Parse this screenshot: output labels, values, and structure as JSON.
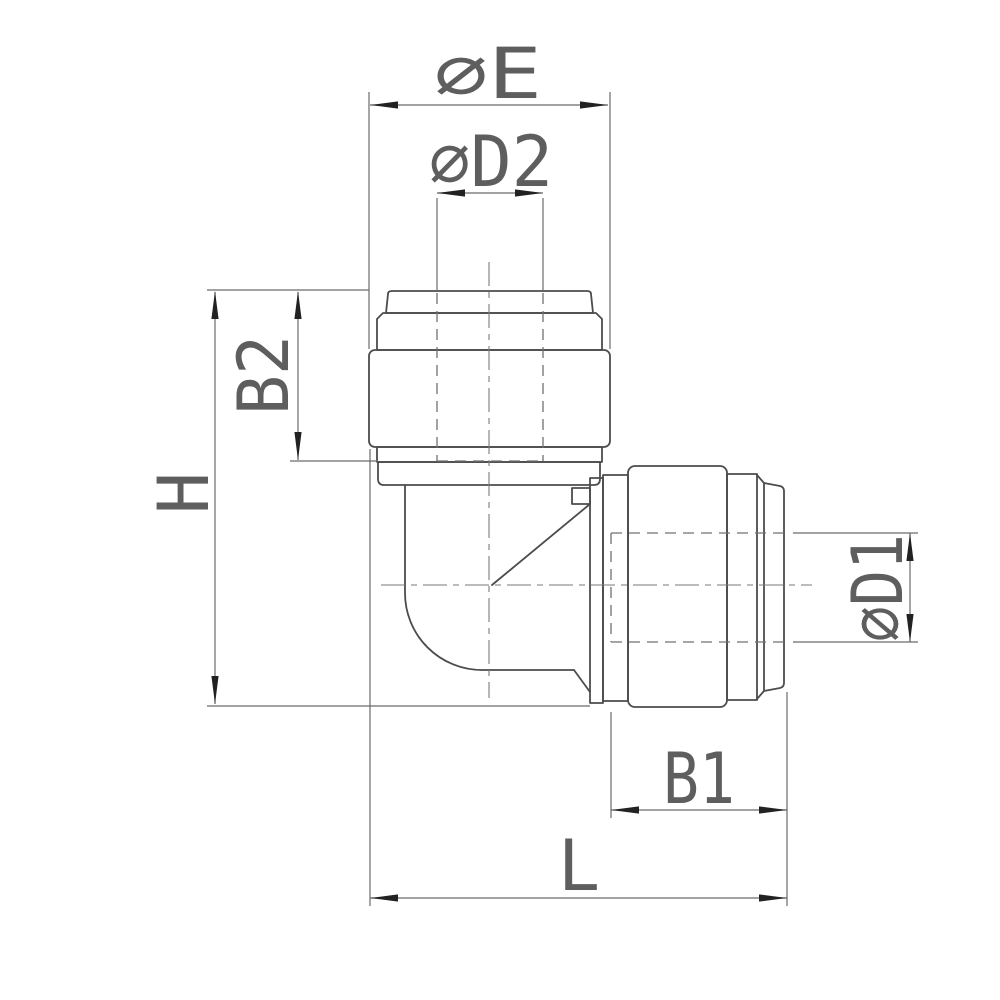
{
  "drawing": {
    "type": "technical-drawing",
    "subject": "90-degree push-fit elbow tube fitting, side elevation with dimension callouts",
    "background": "#ffffff",
    "colors": {
      "outline": "#4c4c4c",
      "dimension_lines": "#6b6b6b",
      "hidden_lines": "#707070",
      "centerlines": "#7a7a7a",
      "arrowheads": "#222222",
      "label_text": "#5e5e5e"
    },
    "labels": {
      "top_outer_diameter": "∅E",
      "top_bore_diameter": "∅D2",
      "top_grip_length": "B2",
      "overall_height": "H",
      "side_bore_diameter": "∅D1",
      "side_grip_length": "B1",
      "overall_length": "L"
    }
  }
}
